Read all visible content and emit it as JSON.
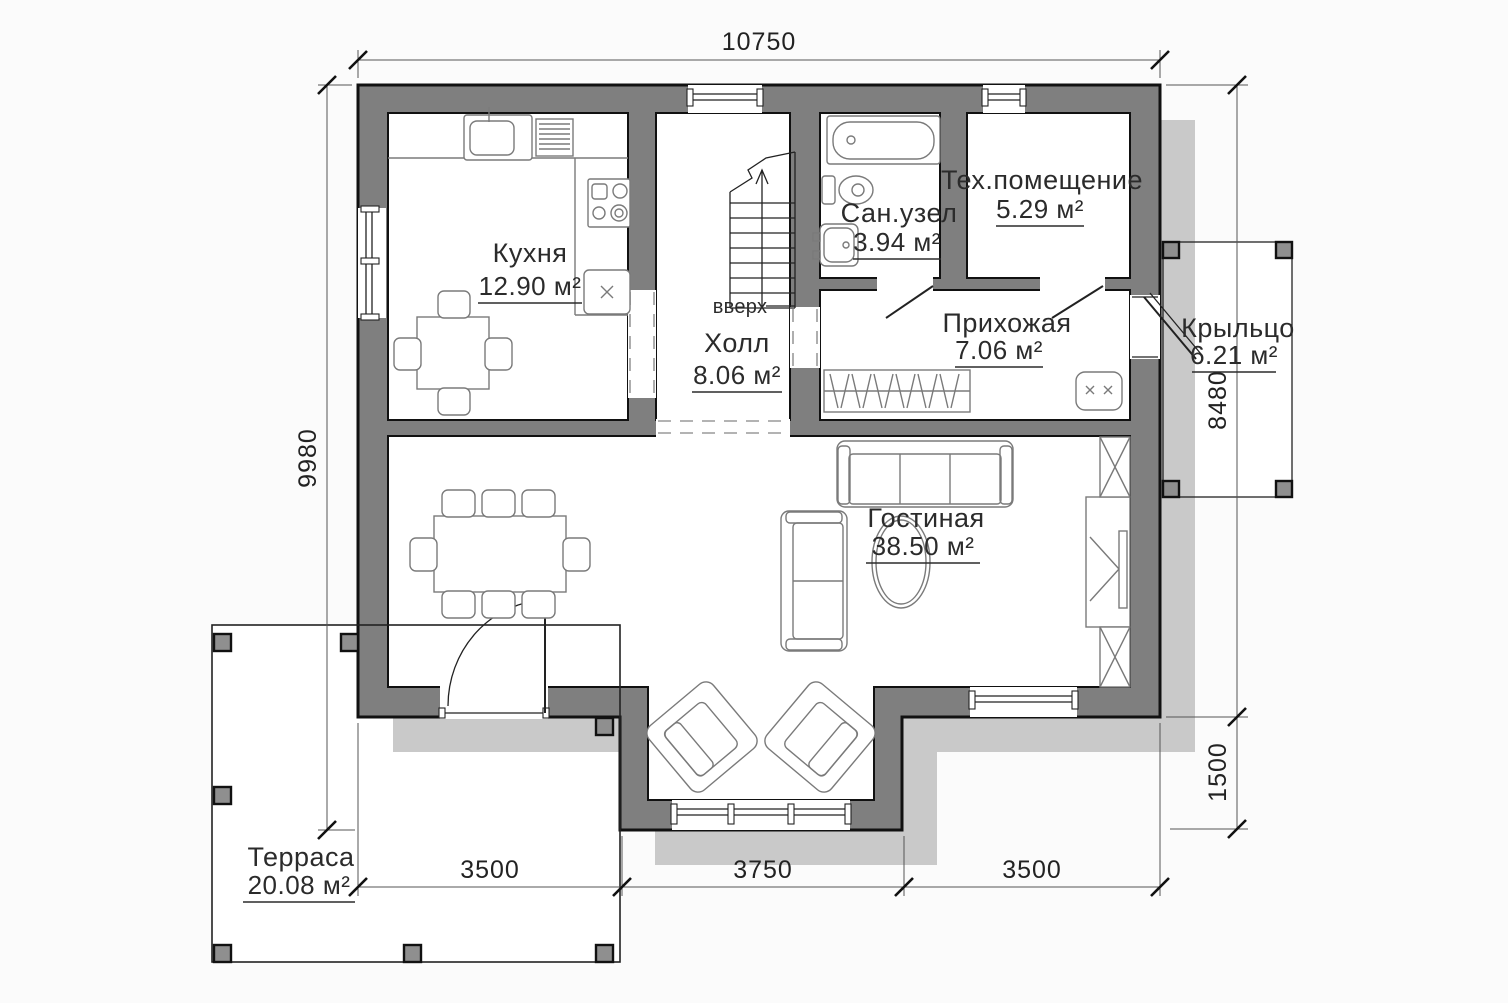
{
  "rooms": {
    "kitchen": {
      "name": "Кухня",
      "area": "12.90 м²"
    },
    "hall": {
      "name": "Холл",
      "area": "8.06 м²"
    },
    "bathroom": {
      "name": "Сан.узел",
      "area": "3.94 м²"
    },
    "tech": {
      "name": "Тех.помещение",
      "area": "5.29 м²"
    },
    "entry": {
      "name": "Прихожая",
      "area": "7.06 м²"
    },
    "porch": {
      "name": "Крыльцо",
      "area": "6.21 м²"
    },
    "living": {
      "name": "Гостиная",
      "area": "38.50 м²"
    },
    "terrace": {
      "name": "Терраса",
      "area": "20.08 м²"
    }
  },
  "annotations": {
    "stairs_up": "вверх"
  },
  "dimensions": {
    "top_width": "10750",
    "left_height": "9980",
    "right_height_main": "8480",
    "right_height_lower": "1500",
    "bottom_left": "3500",
    "bottom_center": "3750",
    "bottom_right": "3500"
  },
  "colors": {
    "wall": "#7f7f7f",
    "shadow": "#c9c9c9",
    "outline": "#111111",
    "background": "#fbfbfb",
    "post": "#8f8f8f"
  }
}
